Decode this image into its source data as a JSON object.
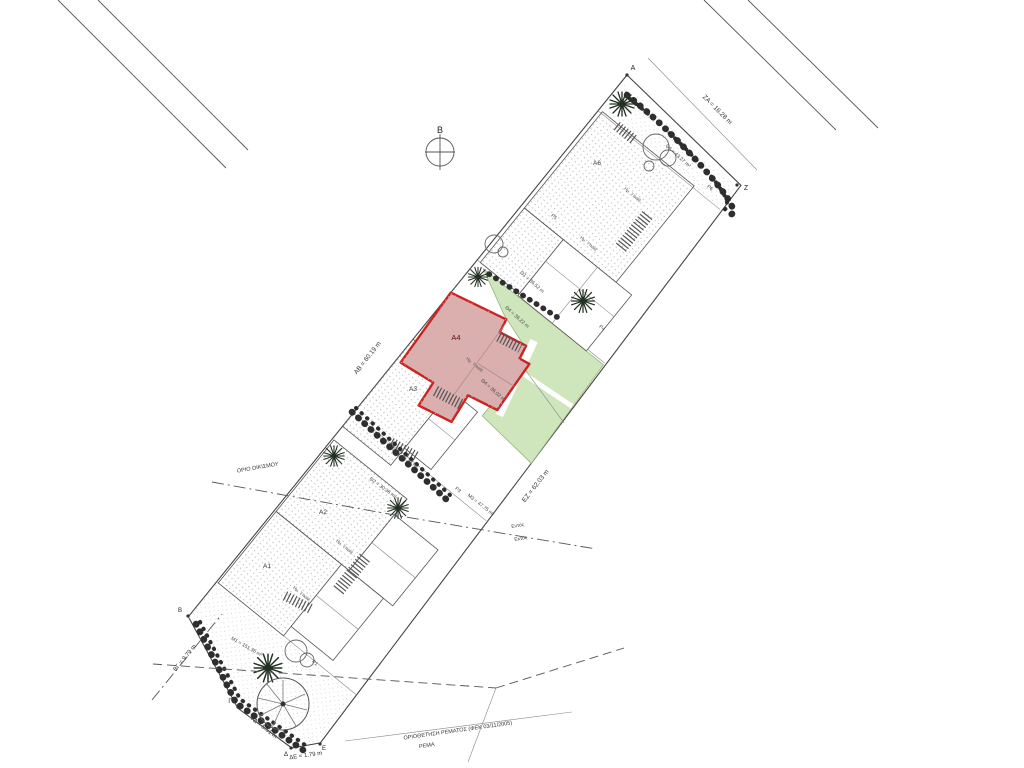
{
  "meta": {
    "type": "architectural-site-plan",
    "language": "Greek",
    "highlighted_unit": "Α4"
  },
  "colors": {
    "highlight_outline": "#cc2321",
    "highlight_fill": "#dcaeae",
    "garden_fill": "#cfe6bc",
    "line": "#555555",
    "background": "#ffffff"
  },
  "boundary_points": [
    "Α",
    "Β",
    "Γ",
    "Δ",
    "Ε",
    "Ζ"
  ],
  "buildings": [
    "Α1",
    "Α2",
    "Α3",
    "Α4",
    "Α6"
  ],
  "labels": [
    {
      "id": "north-label",
      "text": "Β",
      "x": 440,
      "y": 133,
      "rot": 0,
      "size": 9,
      "color": "#222"
    },
    {
      "id": "vertex-a-label",
      "text": "Α",
      "x": 633,
      "y": 70,
      "rot": 0,
      "size": 7,
      "color": "#222"
    },
    {
      "id": "vertex-z-label",
      "text": "Ζ",
      "x": 746,
      "y": 190,
      "rot": 0,
      "size": 7,
      "color": "#222"
    },
    {
      "id": "vertex-b-label",
      "text": "Β",
      "x": 180,
      "y": 612,
      "rot": 0,
      "size": 6,
      "color": "#222"
    },
    {
      "id": "vertex-g-label",
      "text": "Γ",
      "x": 230,
      "y": 703,
      "rot": 0,
      "size": 6,
      "color": "#222"
    },
    {
      "id": "vertex-d-label",
      "text": "Δ",
      "x": 286,
      "y": 756,
      "rot": 0,
      "size": 6,
      "color": "#222"
    },
    {
      "id": "vertex-e-label",
      "text": "Ε",
      "x": 324,
      "y": 750,
      "rot": 0,
      "size": 6,
      "color": "#222"
    },
    {
      "id": "dim-za",
      "text": "ΖΑ = 16.28 m",
      "x": 716,
      "y": 111,
      "rot": 45,
      "size": 6.5,
      "color": "#333"
    },
    {
      "id": "dim-ab",
      "text": "ΑΒ = 60.19 m",
      "x": 369,
      "y": 359,
      "rot": -52,
      "size": 6.5,
      "color": "#333"
    },
    {
      "id": "dim-ez",
      "text": "ΕΖ = 62.03 m",
      "x": 537,
      "y": 487,
      "rot": -52,
      "size": 6.5,
      "color": "#333"
    },
    {
      "id": "dim-bg",
      "text": "ΒΓ = 9.79 m",
      "x": 186,
      "y": 659,
      "rot": -51,
      "size": 6,
      "color": "#333"
    },
    {
      "id": "dim-gd",
      "text": "ΓΔ = 5.51 m",
      "x": 263,
      "y": 729,
      "rot": 38,
      "size": 6,
      "color": "#333"
    },
    {
      "id": "dim-de",
      "text": "ΔΕ = 1.79 m",
      "x": 306,
      "y": 757,
      "rot": -8,
      "size": 6,
      "color": "#333"
    },
    {
      "id": "bldg-a6-label",
      "text": "Α6",
      "x": 597,
      "y": 165,
      "rot": 0,
      "size": 6.5,
      "color": "#333"
    },
    {
      "id": "bldg-a4-label",
      "text": "Α4",
      "x": 456,
      "y": 340,
      "rot": 0,
      "size": 7.5,
      "color": "#5a1111"
    },
    {
      "id": "bldg-a3-label",
      "text": "Α3",
      "x": 413,
      "y": 391,
      "rot": 0,
      "size": 6.5,
      "color": "#333"
    },
    {
      "id": "bldg-a2-label",
      "text": "Α2",
      "x": 323,
      "y": 514,
      "rot": 0,
      "size": 6.5,
      "color": "#333"
    },
    {
      "id": "bldg-a1-label",
      "text": "Α1",
      "x": 267,
      "y": 568,
      "rot": 0,
      "size": 6.5,
      "color": "#333"
    },
    {
      "id": "p6-label",
      "text": "Ρ6",
      "x": 709,
      "y": 189,
      "rot": 40,
      "size": 5,
      "color": "#444"
    },
    {
      "id": "p5-label",
      "text": "Ρ5",
      "x": 553,
      "y": 218,
      "rot": 40,
      "size": 5,
      "color": "#444"
    },
    {
      "id": "p4-label",
      "text": "Ρ4",
      "x": 601,
      "y": 329,
      "rot": 40,
      "size": 5,
      "color": "#444"
    },
    {
      "id": "p3-label",
      "text": "Ρ3",
      "x": 457,
      "y": 491,
      "rot": 40,
      "size": 5,
      "color": "#444"
    },
    {
      "id": "p1-label",
      "text": "Ρ1",
      "x": 314,
      "y": 664,
      "rot": 40,
      "size": 5,
      "color": "#444"
    },
    {
      "id": "theta6-label",
      "text": "Θ6 = 43.27 m²",
      "x": 677,
      "y": 157,
      "rot": 42,
      "size": 5,
      "color": "#444"
    },
    {
      "id": "theta1-label",
      "text": "Θ1 = 36.52 m",
      "x": 531,
      "y": 283,
      "rot": 42,
      "size": 5,
      "color": "#444"
    },
    {
      "id": "theta4a-label",
      "text": "Θ4 = 36.22 m",
      "x": 516,
      "y": 318,
      "rot": 42,
      "size": 5,
      "color": "#444"
    },
    {
      "id": "theta4b-label",
      "text": "Θ4 = 36.02 m",
      "x": 492,
      "y": 391,
      "rot": 42,
      "size": 5,
      "color": "#444"
    },
    {
      "id": "theta3-label",
      "text": "Θ3 = 36.33 m²",
      "x": 404,
      "y": 459,
      "rot": 36,
      "size": 5,
      "color": "#444"
    },
    {
      "id": "theta2-label",
      "text": "Θ2 = 30.36 m²",
      "x": 382,
      "y": 489,
      "rot": 36,
      "size": 5,
      "color": "#444"
    },
    {
      "id": "m3-label",
      "text": "Μ3 = 47.75 m²",
      "x": 480,
      "y": 506,
      "rot": 38,
      "size": 5,
      "color": "#444"
    },
    {
      "id": "m1-label",
      "text": "Μ1 = 151.36 m²",
      "x": 246,
      "y": 648,
      "rot": 30,
      "size": 5,
      "color": "#444"
    },
    {
      "id": "semi-open-1",
      "text": "Ημ. Υπαίθ.",
      "x": 474,
      "y": 366,
      "rot": 40,
      "size": 4.5,
      "color": "#555"
    },
    {
      "id": "semi-open-2",
      "text": "Ημ. Υπαίθ.",
      "x": 344,
      "y": 548,
      "rot": 40,
      "size": 4.5,
      "color": "#555"
    },
    {
      "id": "semi-open-3",
      "text": "Ημ. Υπαίθ.",
      "x": 301,
      "y": 595,
      "rot": 40,
      "size": 4.5,
      "color": "#555"
    },
    {
      "id": "semi-open-4",
      "text": "Ημ. Υπαίθ.",
      "x": 588,
      "y": 245,
      "rot": 40,
      "size": 4.5,
      "color": "#555"
    },
    {
      "id": "semi-open-5",
      "text": "Ημ. Υπαίθ.",
      "x": 632,
      "y": 196,
      "rot": 40,
      "size": 4.5,
      "color": "#555"
    },
    {
      "id": "settlement-boundary-label",
      "text": "ΟΡΙΟ ΟΙΚΙΣΜΟΥ",
      "x": 258,
      "y": 469,
      "rot": -10,
      "size": 5.5,
      "color": "#333"
    },
    {
      "id": "entos-label",
      "text": "Εντός",
      "x": 518,
      "y": 527,
      "rot": -10,
      "size": 5,
      "color": "#444"
    },
    {
      "id": "ektos-label",
      "text": "Εκτός",
      "x": 521,
      "y": 540,
      "rot": -10,
      "size": 5,
      "color": "#444"
    },
    {
      "id": "stream-delimitation-label",
      "text": "ΟΡΙΟΘΕΤΗΣΗ ΡΕΜΑΤΟΣ (ΦΕΚ 03/11/2005)",
      "x": 458,
      "y": 732,
      "rot": -8,
      "size": 5.5,
      "color": "#333"
    },
    {
      "id": "stream-label",
      "text": "ΡΕΜΑ",
      "x": 427,
      "y": 747,
      "rot": -8,
      "size": 5.5,
      "color": "#333"
    }
  ]
}
